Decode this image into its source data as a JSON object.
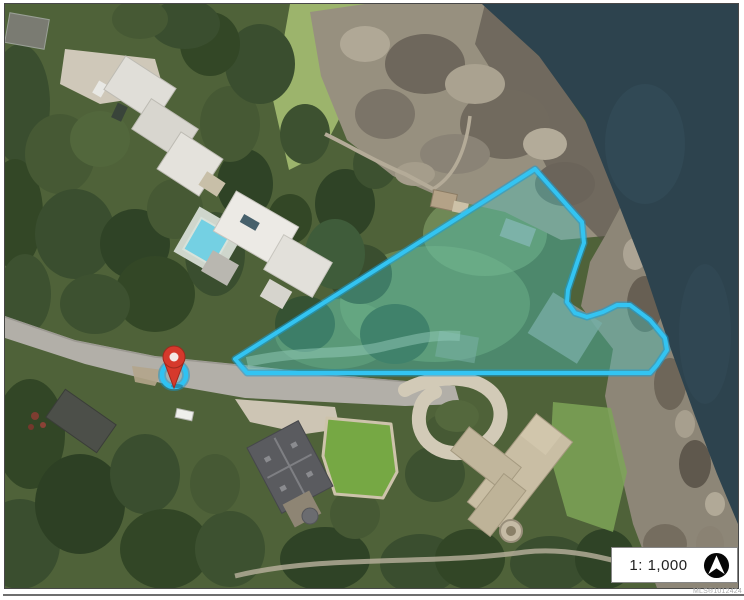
{
  "map": {
    "scalebar": {
      "label": "1: 1,000"
    },
    "watermark": "MLS®1012424",
    "icons": {
      "north_arrow": "compass-north-arrow",
      "pin": "map-location-pin"
    },
    "boundary": {
      "points": "530,165 577,218 579,239 573,256 563,286 562,298 570,309 582,313 598,308 612,301 625,301 645,316 660,334 662,346 652,361 645,369 242,369 230,355",
      "stroke_color": "#33c4f2",
      "under_stroke": "#1a9cd4",
      "fill_rgba": "rgba(74,201,193,0.38)"
    },
    "pin": {
      "color": "#d6392c",
      "edge_color": "#9e2a1f",
      "ring_color": "#2fc2f2"
    },
    "colors": {
      "water": "#2d434e",
      "vegetation": "#4f6239",
      "rock": "#97907f",
      "rock_coast": "#8d8677",
      "road": "#b2afa8"
    }
  }
}
